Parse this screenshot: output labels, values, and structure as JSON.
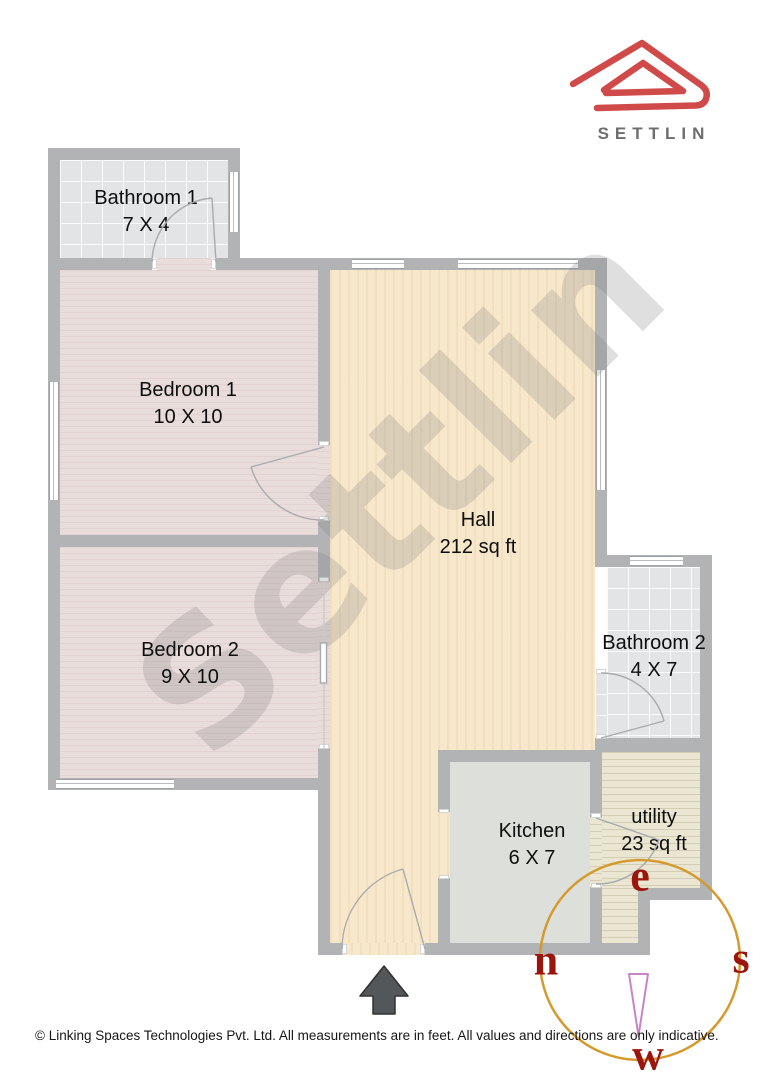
{
  "logo": {
    "brand": "SETTLIN"
  },
  "watermark": {
    "text": "Settlin"
  },
  "rooms": {
    "bathroom1": {
      "name": "Bathroom 1",
      "dims": "7 X 4"
    },
    "bedroom1": {
      "name": "Bedroom 1",
      "dims": "10 X 10"
    },
    "bedroom2": {
      "name": "Bedroom 2",
      "dims": "9 X 10"
    },
    "hall": {
      "name": "Hall",
      "dims": "212 sq ft"
    },
    "bathroom2": {
      "name": "Bathroom 2",
      "dims": "4 X 7"
    },
    "kitchen": {
      "name": "Kitchen",
      "dims": "6 X 7"
    },
    "utility": {
      "name": "utility",
      "dims": "23 sq ft"
    }
  },
  "compass": {
    "n": "n",
    "e": "e",
    "s": "s",
    "w": "w"
  },
  "colors": {
    "wall": "#b1b3b5",
    "hall_floor": "#f8e8cb",
    "bedroom_floor": "#e9dddc",
    "tile_floor": "#e3e4e6",
    "kitchen_floor": "#dcdfda",
    "utility_floor": "#eae6d2",
    "logo_red": "#d14a4a",
    "compass_ring": "#d59a2e",
    "compass_letters": "#9b150c",
    "needle_pink": "#c885c5"
  },
  "footer": {
    "text": "© Linking Spaces Technologies Pvt. Ltd. All measurements are in feet. All values and directions are only indicative."
  }
}
